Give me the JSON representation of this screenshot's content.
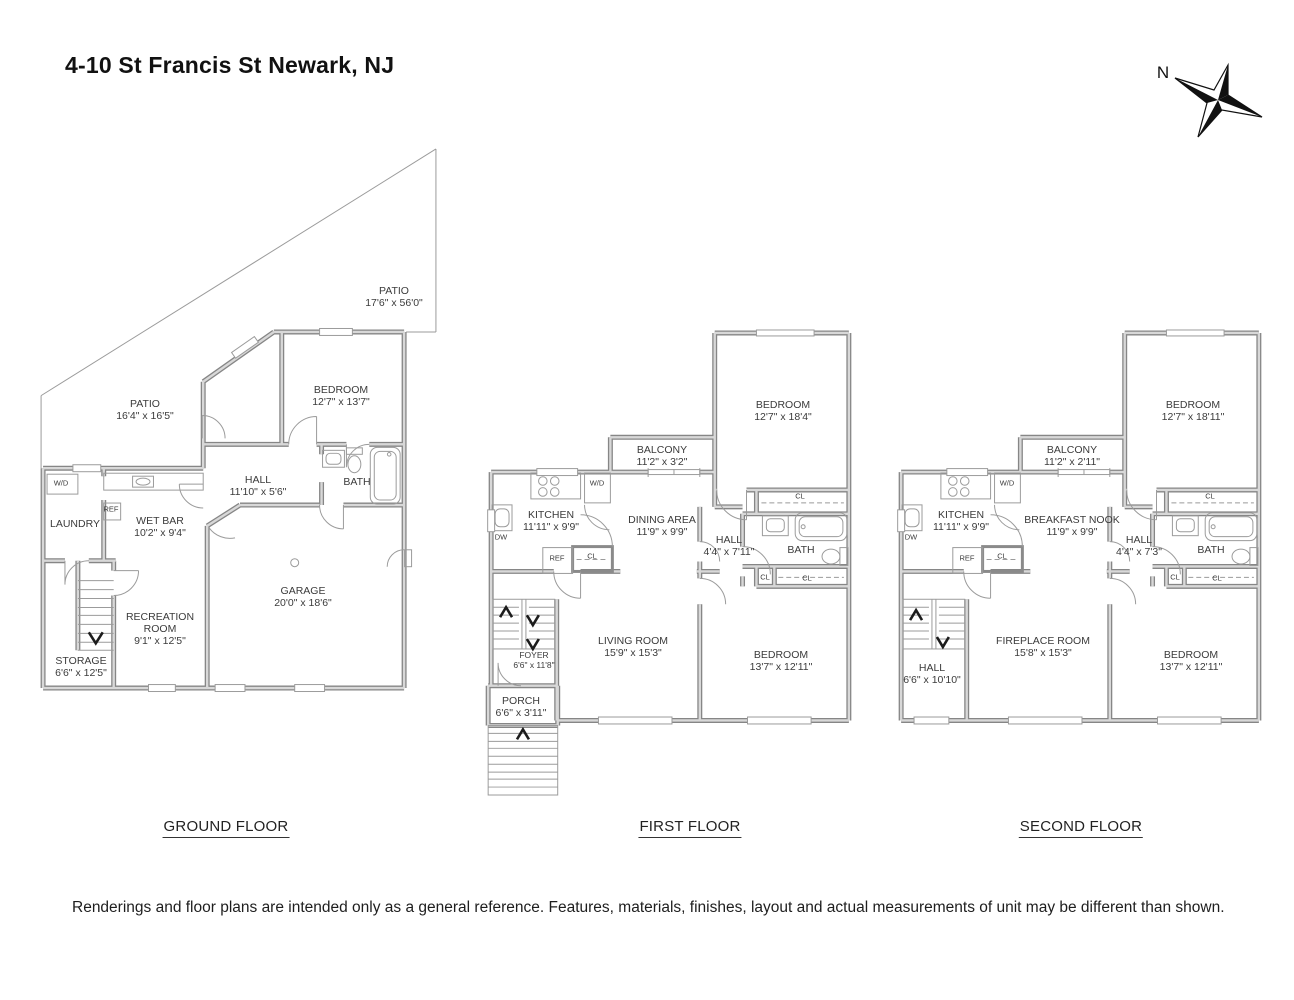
{
  "title": "4-10 St Francis St Newark, NJ",
  "compass": {
    "north_label": "N"
  },
  "floors": [
    {
      "label": "GROUND FLOOR",
      "rooms": [
        {
          "name": "PATIO",
          "dims": "17'6\" x 56'0\""
        },
        {
          "name": "PATIO",
          "dims": "16'4\" x 16'5\""
        },
        {
          "name": "BEDROOM",
          "dims": "12'7\" x 13'7\""
        },
        {
          "name": "HALL",
          "dims": "11'10\" x 5'6\""
        },
        {
          "name": "BATH"
        },
        {
          "name": "LAUNDRY"
        },
        {
          "name": "WET BAR",
          "dims": "10'2\" x 9'4\""
        },
        {
          "name": "GARAGE",
          "dims": "20'0\" x 18'6\""
        },
        {
          "name": "RECREATION ROOM",
          "dims": "9'1\" x 12'5\""
        },
        {
          "name": "STORAGE",
          "dims": "6'6\" x 12'5\""
        }
      ],
      "fixtures": [
        {
          "label": "W/D"
        },
        {
          "label": "REF"
        }
      ]
    },
    {
      "label": "FIRST FLOOR",
      "rooms": [
        {
          "name": "BEDROOM",
          "dims": "12'7\" x 18'4\""
        },
        {
          "name": "BALCONY",
          "dims": "11'2\" x 3'2\""
        },
        {
          "name": "KITCHEN",
          "dims": "11'11\" x 9'9\""
        },
        {
          "name": "DINING AREA",
          "dims": "11'9\" x 9'9\""
        },
        {
          "name": "HALL",
          "dims": "4'4\" x 7'11\""
        },
        {
          "name": "BATH"
        },
        {
          "name": "LIVING ROOM",
          "dims": "15'9\" x 15'3\""
        },
        {
          "name": "BEDROOM",
          "dims": "13'7\" x 12'11\""
        },
        {
          "name": "FOYER",
          "dims": "6'6\" x 11'8\""
        },
        {
          "name": "PORCH",
          "dims": "6'6\" x 3'11\""
        }
      ],
      "fixtures": [
        {
          "label": "W/D"
        },
        {
          "label": "DW"
        },
        {
          "label": "REF"
        },
        {
          "label": "CL"
        },
        {
          "label": "CL"
        },
        {
          "label": "CL"
        },
        {
          "label": "CL"
        }
      ]
    },
    {
      "label": "SECOND FLOOR",
      "rooms": [
        {
          "name": "BEDROOM",
          "dims": "12'7\" x 18'11\""
        },
        {
          "name": "BALCONY",
          "dims": "11'2\" x 2'11\""
        },
        {
          "name": "KITCHEN",
          "dims": "11'11\" x 9'9\""
        },
        {
          "name": "BREAKFAST NOOK",
          "dims": "11'9\" x 9'9\""
        },
        {
          "name": "HALL",
          "dims": "4'4\" x 7'3\""
        },
        {
          "name": "BATH"
        },
        {
          "name": "FIREPLACE ROOM",
          "dims": "15'8\" x 15'3\""
        },
        {
          "name": "BEDROOM",
          "dims": "13'7\" x 12'11\""
        },
        {
          "name": "HALL",
          "dims": "6'6\" x 10'10\""
        }
      ],
      "fixtures": [
        {
          "label": "W/D"
        },
        {
          "label": "DW"
        },
        {
          "label": "REF"
        },
        {
          "label": "CL"
        },
        {
          "label": "CL"
        },
        {
          "label": "CL"
        },
        {
          "label": "CL"
        }
      ]
    }
  ],
  "disclaimer": "Renderings and floor plans are intended only as a general reference. Features, materials, finishes, layout and actual measurements of unit may be different than shown.",
  "colors": {
    "wall_edge": "#868686",
    "wall_core": "#d8d8d8",
    "line": "#9b9b9b",
    "text": "#3b3b3b"
  }
}
